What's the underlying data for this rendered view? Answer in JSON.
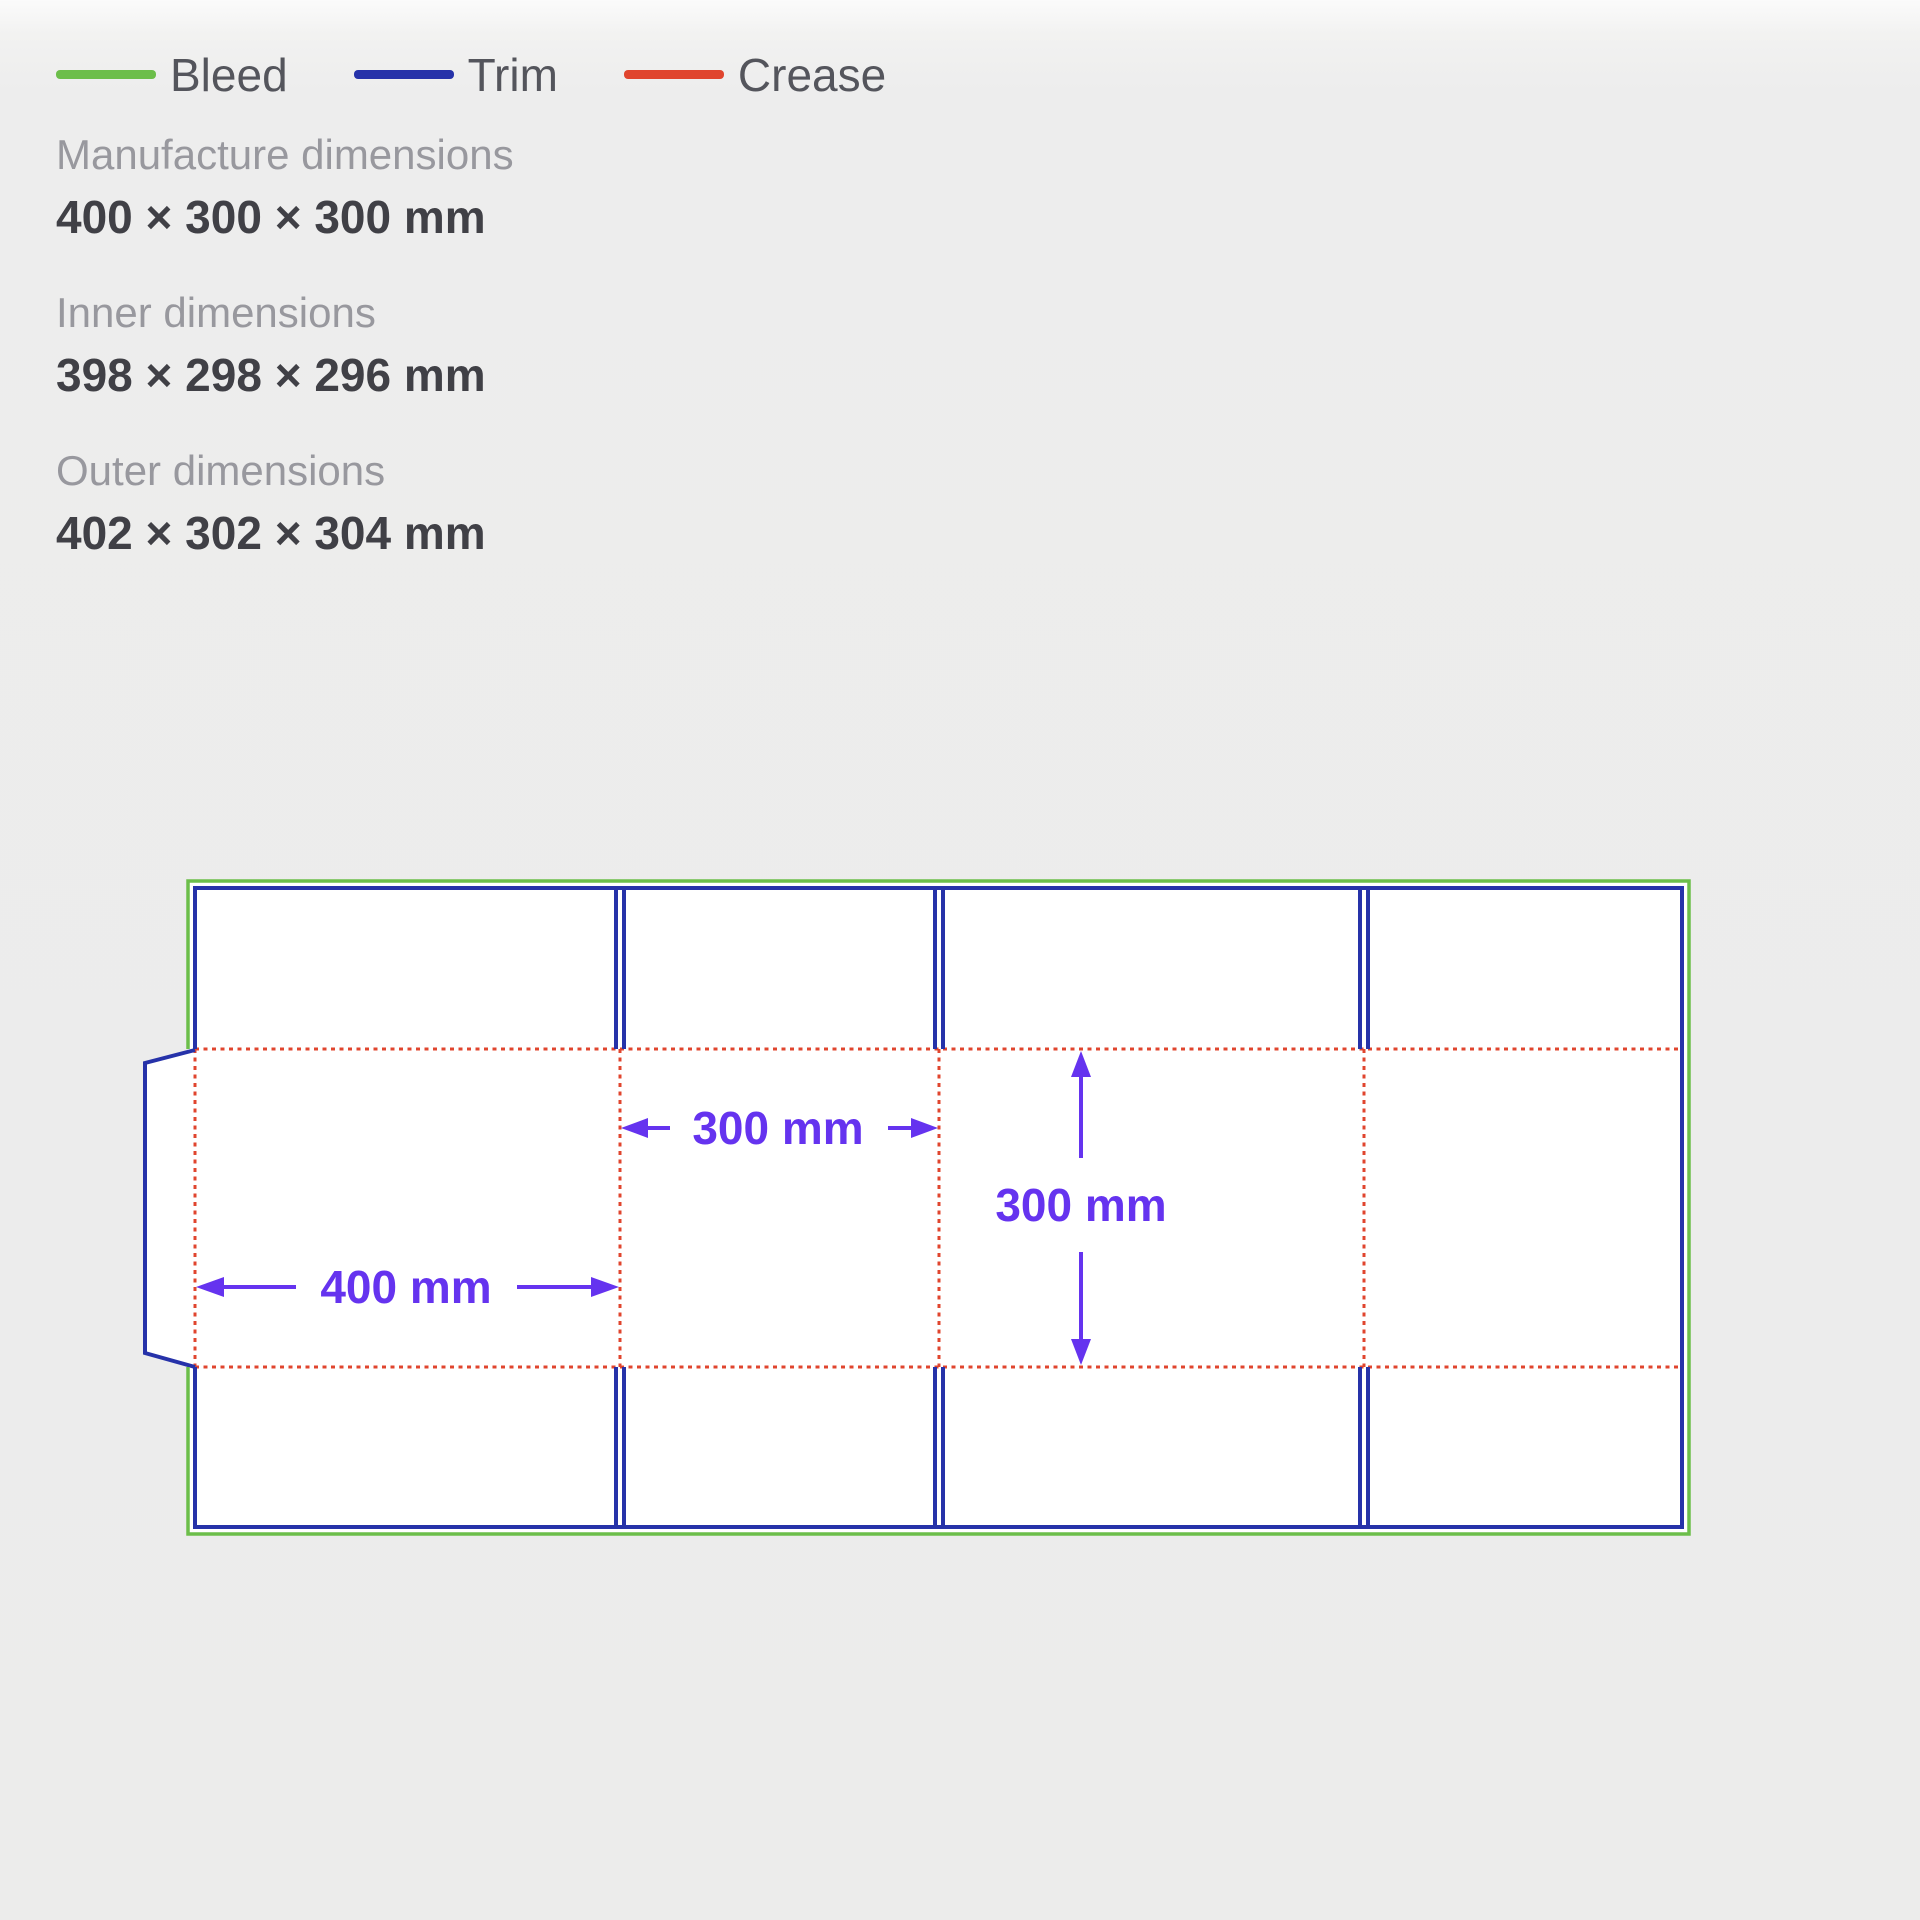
{
  "legend": {
    "items": [
      {
        "label": "Bleed",
        "color": "#6cbe4a"
      },
      {
        "label": "Trim",
        "color": "#2632a9"
      },
      {
        "label": "Crease",
        "color": "#e0452e"
      }
    ]
  },
  "specs": {
    "manufacture": {
      "label": "Manufacture dimensions",
      "value": "400 × 300 × 300 mm"
    },
    "inner": {
      "label": "Inner dimensions",
      "value": "398 × 298 × 296 mm"
    },
    "outer": {
      "label": "Outer dimensions",
      "value": "402 × 302 × 304 mm"
    }
  },
  "diagram": {
    "colors": {
      "bleed": "#6cbe4a",
      "trim": "#2632a9",
      "crease": "#e0452e",
      "dimension": "#6533ef",
      "panel_fill": "#ffffff"
    },
    "dimensions": {
      "width_label": "400 mm",
      "depth_label": "300 mm",
      "height_label": "300 mm"
    }
  }
}
